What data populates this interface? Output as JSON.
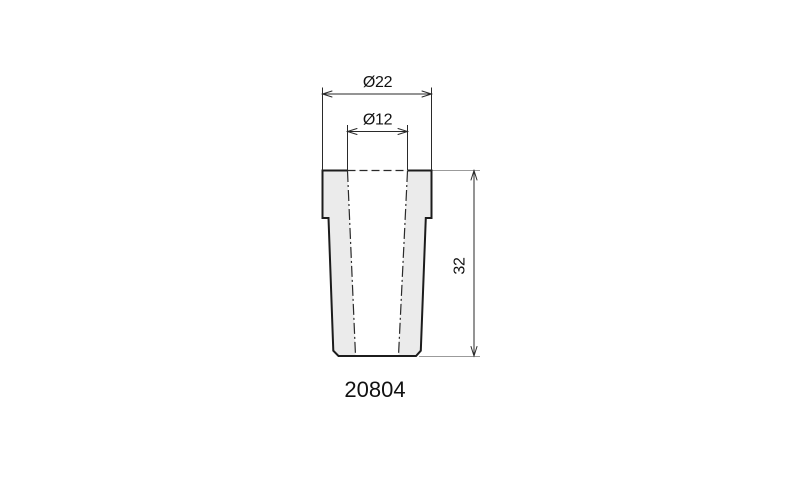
{
  "drawing": {
    "kind": "technical-dimension-drawing",
    "part_number": "20804",
    "dimensions": {
      "outer_diameter_label": "Ø22",
      "inner_diameter_label": "Ø12",
      "height_label": "32"
    },
    "colors": {
      "background": "#ffffff",
      "outline": "#1c1c1c",
      "part_fill": "#ebebeb",
      "bore_fill": "#ffffff",
      "dimension_lines": "#2a2a2a",
      "reference_lines": "#9b9b9b",
      "text": "#111111"
    }
  }
}
